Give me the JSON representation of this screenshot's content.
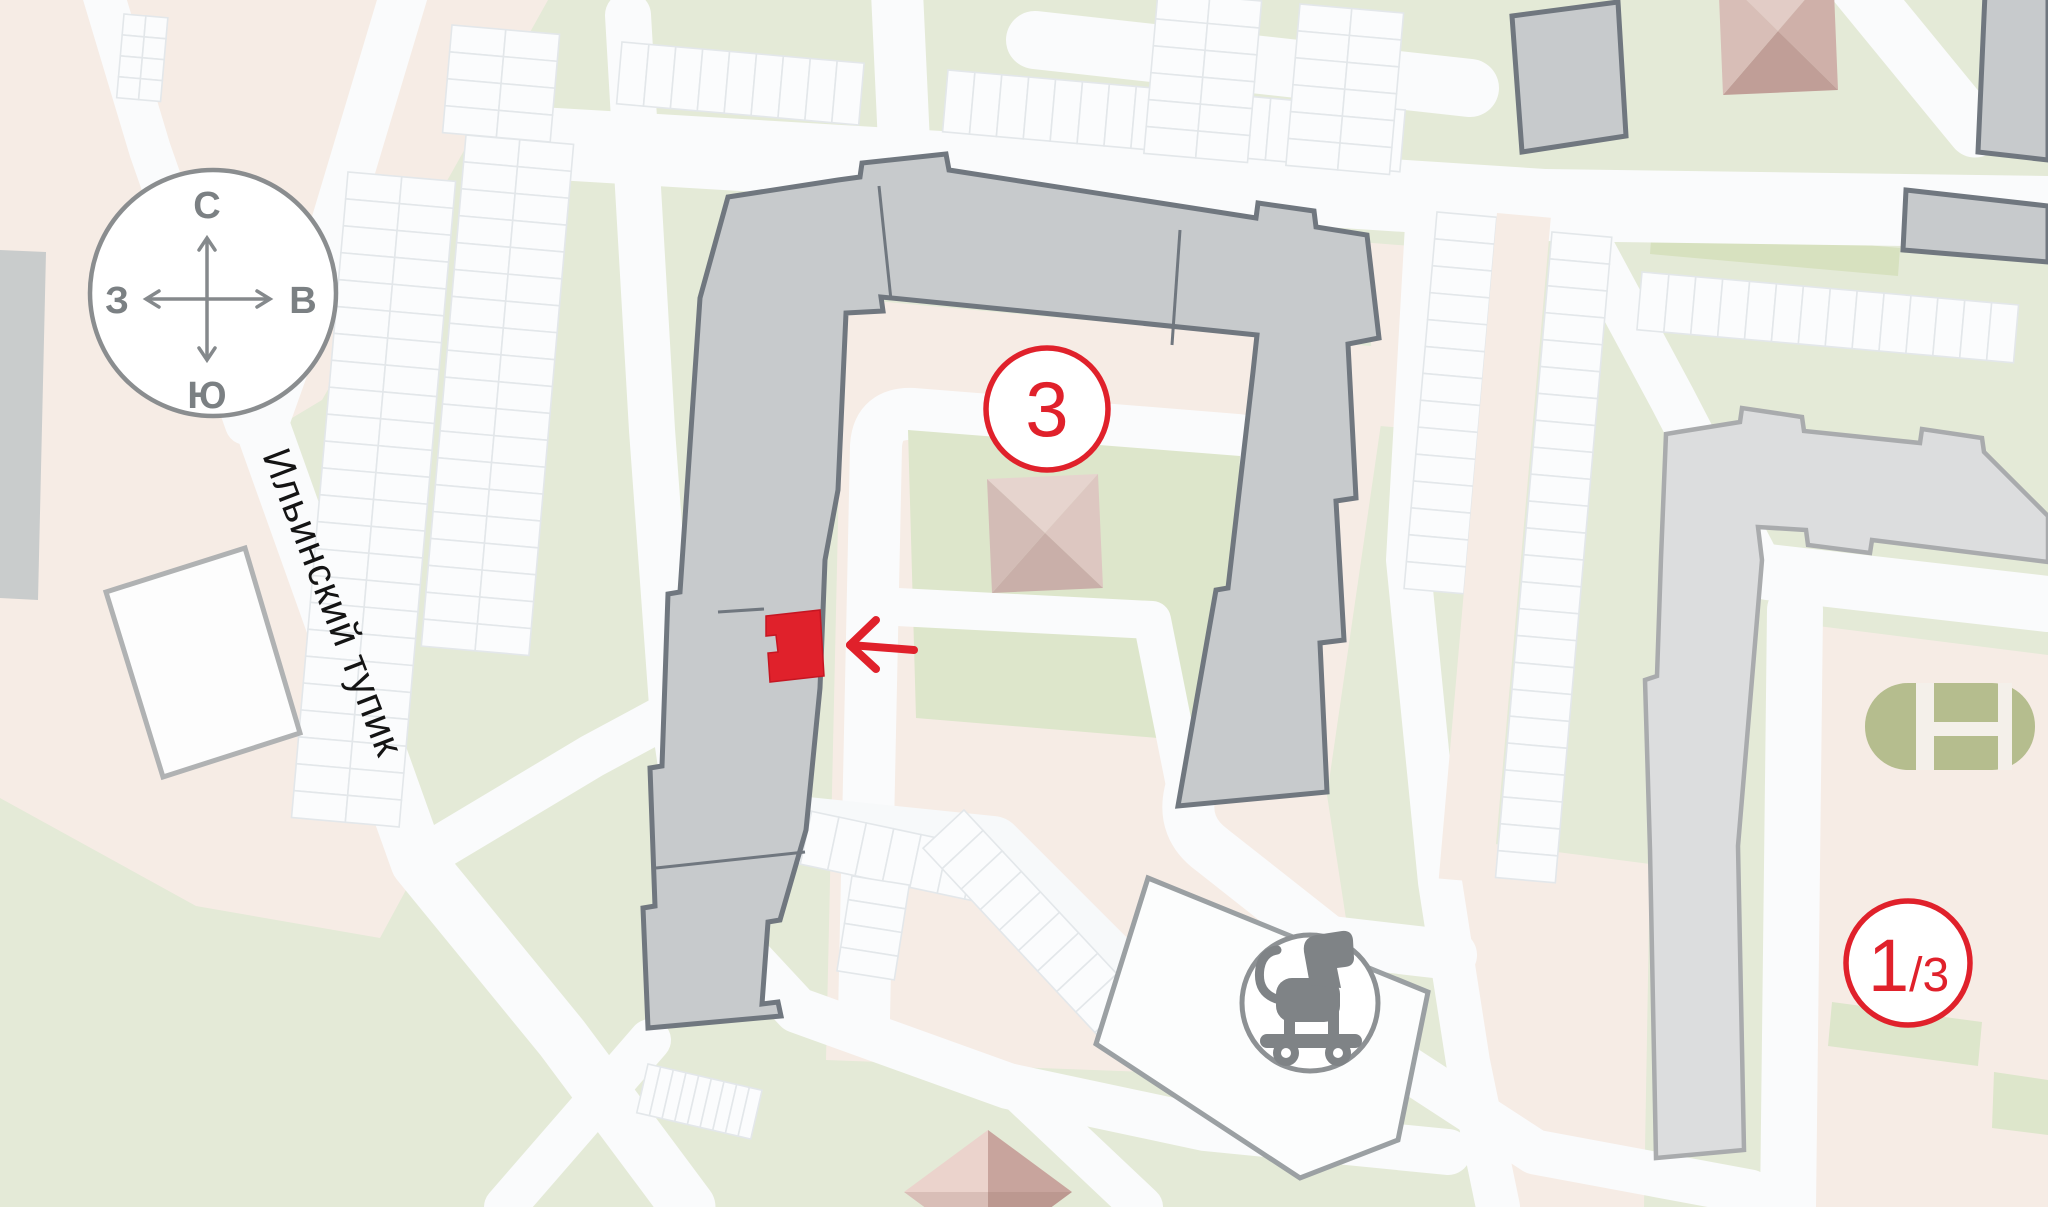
{
  "map": {
    "street": {
      "label": "Ильинский тупик"
    },
    "compass": {
      "north": "С",
      "south": "Ю",
      "west": "З",
      "east": "В"
    },
    "building_badge": {
      "number": "3"
    },
    "corner_badge": {
      "primary": "1",
      "secondary": "/3"
    },
    "icons": {
      "playground_marker": "rocking-horse-icon",
      "selection_pointer": "left-arrow-icon",
      "courtyard_structures": "pyramid-roof-icon",
      "sports_court": "stadium-court-shape"
    },
    "colors": {
      "accent_red": "#E0212B",
      "building_fill": "#C7CACC",
      "building_outline": "#70777F",
      "light_building_fill": "#DCDDDE",
      "green_base": "#E4EAD7",
      "pink_yard": "#F6ECE5",
      "road_white": "#FAFBFC",
      "court_olive": "#B5BD8E",
      "icon_gray": "#7F8386"
    }
  }
}
